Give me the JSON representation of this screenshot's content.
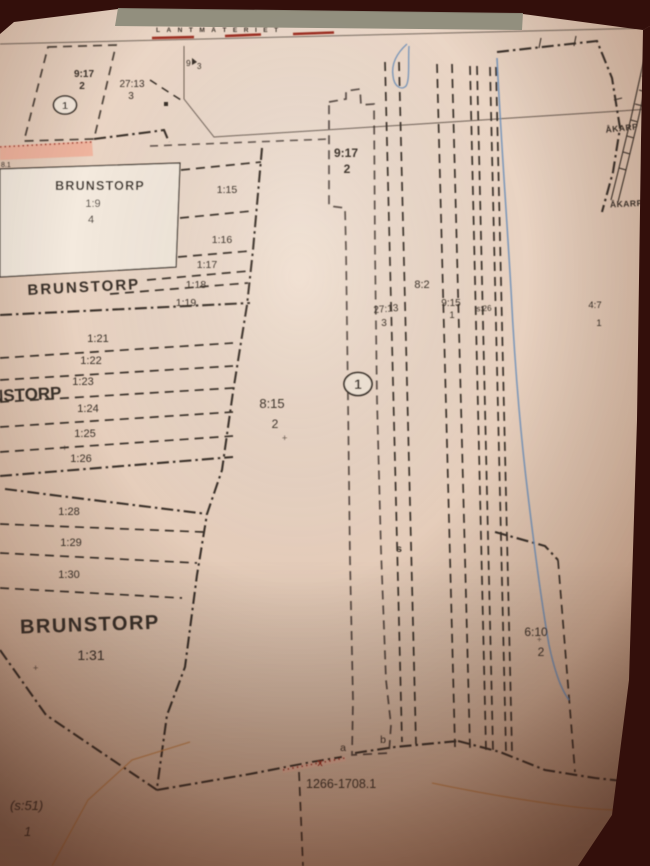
{
  "agency_header": {
    "name": "LANTMÄTERIET"
  },
  "act": {
    "number": "1266-1708.1",
    "number_partial": "8.1"
  },
  "place_names": {
    "brunstorp_inset_title": "BRUNSTORP",
    "brunstorp_inset_id": "1:9",
    "brunstorp_inset_unit": "4",
    "brunstorp_upper": "BRUNSTORP",
    "brunstorp_mid_partial": "NSTORP",
    "brunstorp_lower": "BRUNSTORP",
    "brunstorp_lower_id": "1:31",
    "akarp_upper": "ÅKARP",
    "akarp_lower": "ÅKARP"
  },
  "strip_parcels_upper": [
    "1:15",
    "1:16",
    "1:17",
    "1:18",
    "1:19"
  ],
  "strip_parcels_mid": [
    "1:21",
    "1:22",
    "1:23",
    "1:24",
    "1:25",
    "1:26"
  ],
  "strip_parcels_lower": [
    "1:28",
    "1:29",
    "1:30"
  ],
  "parcel_labels": {
    "p9_17_left_id": "9:17",
    "p9_17_left_unit": "2",
    "p27_13_left_id": "27:13",
    "p27_13_left_unit": "3",
    "p9_3_a": "9",
    "p9_3_b": "3",
    "p9_17_mid_id": "9:17",
    "p9_17_mid_unit": "2",
    "p8_15_id": "8:15",
    "p8_15_unit": "2",
    "p8_2": "8:2",
    "p27_13_mid_id": "27:13",
    "p27_13_mid_unit": "3",
    "p9_15_id": "9:15",
    "p9_15_unit": "1",
    "ps_26": "s:26",
    "p4_7_id": "4:7",
    "p4_7_unit": "1",
    "p6_10_id": "6:10",
    "p6_10_unit": "2",
    "ps_51_id": "(s:51)",
    "ps_51_unit": "1"
  },
  "point_labels": {
    "circle_left": "1",
    "circle_mid": "1",
    "a": "a",
    "b": "b",
    "x": "x",
    "s": "s",
    "plus": "+"
  },
  "colors": {
    "background_dark": "#330f0b",
    "page_edge": "#8d8b7a",
    "line_dark": "#3b3129",
    "parcel_fill": "#a78b7e",
    "pink_fill": "#efb09a",
    "red_accent": "#9e2f20",
    "stream_blue": "#6d8fb8",
    "orange_line": "#c08048",
    "inset_fill": "#f4eade"
  }
}
